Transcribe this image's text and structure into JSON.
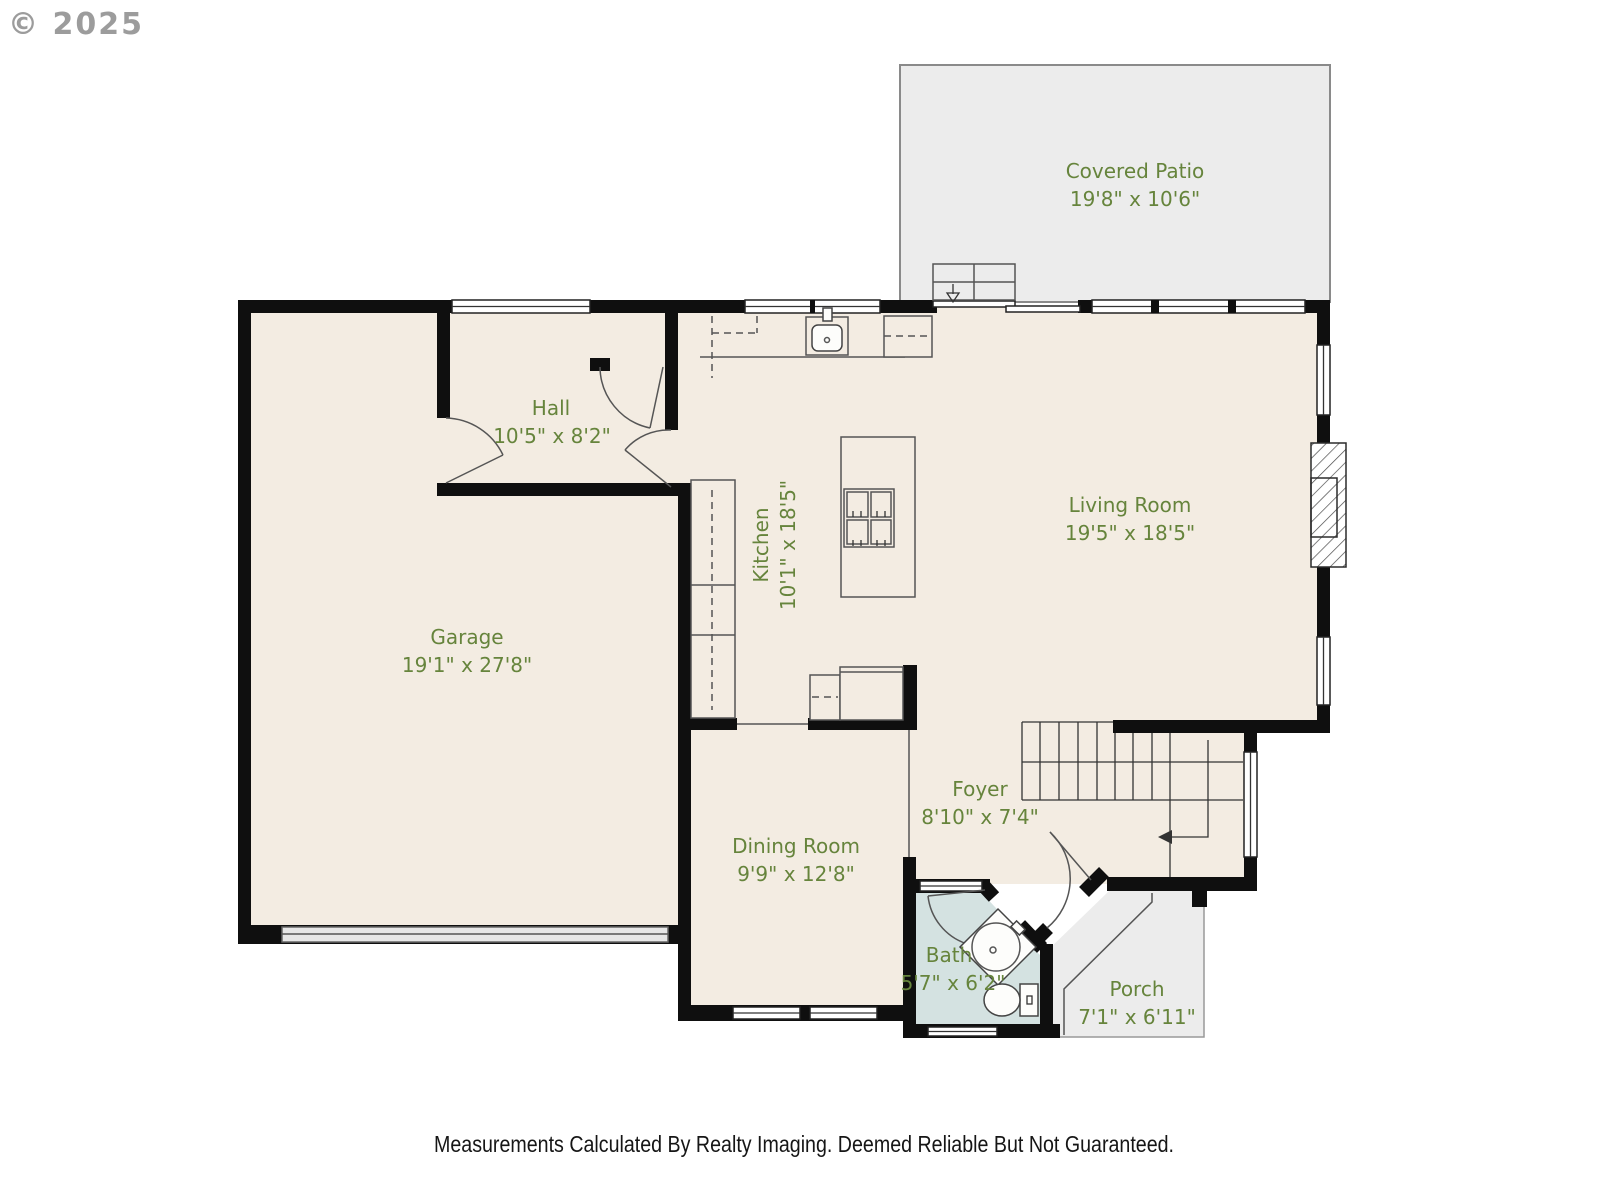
{
  "copyright": "© 2025",
  "disclaimer": "Measurements Calculated By Realty Imaging.  Deemed Reliable But Not Guaranteed.",
  "rooms": [
    {
      "name": "Covered Patio",
      "dims": "19'8\" x 10'6\""
    },
    {
      "name": "Hall",
      "dims": "10'5\" x 8'2\""
    },
    {
      "name": "Kitchen",
      "dims": "10'1\" x 18'5\""
    },
    {
      "name": "Living Room",
      "dims": "19'5\" x 18'5\""
    },
    {
      "name": "Garage",
      "dims": "19'1\" x 27'8\""
    },
    {
      "name": "Dining Room",
      "dims": "9'9\" x 12'8\""
    },
    {
      "name": "Foyer",
      "dims": "8'10\" x 7'4\""
    },
    {
      "name": "Bath",
      "dims": "5'7\" x 6'2\""
    },
    {
      "name": "Porch",
      "dims": "7'1\" x 6'11\""
    }
  ],
  "colors": {
    "wall": "#0f0f0f",
    "room_fill": "#f3ece2",
    "patio_fill": "#ececec",
    "bath_fill": "#d4e2e1",
    "label_green": "#66843c",
    "copyright_gray": "#9c9c9c",
    "disclaimer_black": "#161616"
  }
}
